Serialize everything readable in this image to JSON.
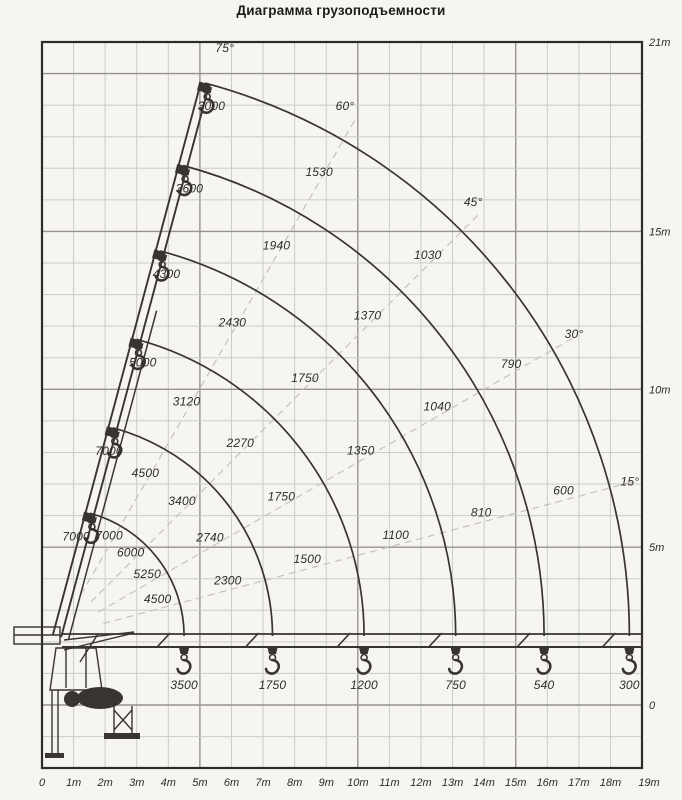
{
  "colors": {
    "background": "#f6f5f2",
    "line": "#38342f",
    "grid_minor": "#cbcbc7",
    "grid_major": "#97948d",
    "frame": "#2d2b27",
    "dashed": "#c6c2bb",
    "text": "#2e2c29"
  },
  "chart_data": {
    "type": "line",
    "title": "Диаграмма грузоподъемности",
    "subtitle": "",
    "units": {
      "load": "kg",
      "distance": "m"
    },
    "x_axis": {
      "range_m": [
        0,
        19
      ],
      "ticks": [
        "0",
        "1m",
        "2m",
        "3m",
        "4m",
        "5m",
        "6m",
        "7m",
        "8m",
        "9m",
        "10m",
        "11m",
        "12m",
        "13m",
        "14m",
        "15m",
        "16m",
        "17m",
        "18m",
        "19m"
      ]
    },
    "y_axis": {
      "side": "right",
      "range_m": [
        -2,
        21
      ],
      "ticks": [
        {
          "label": "21m",
          "m": 21
        },
        {
          "label": "15m",
          "m": 15
        },
        {
          "label": "10m",
          "m": 10
        },
        {
          "label": "5m",
          "m": 5
        },
        {
          "label": "0",
          "m": 0
        }
      ]
    },
    "grid": {
      "minor_step_m": 1,
      "major_step_m": 5
    },
    "angle_lines": [
      {
        "deg": 75,
        "label": "75°"
      },
      {
        "deg": 60,
        "label": "60°"
      },
      {
        "deg": 45,
        "label": "45°"
      },
      {
        "deg": 30,
        "label": "30°"
      },
      {
        "deg": 15,
        "label": "15°"
      }
    ],
    "extensions": [
      {
        "outreach_m": 4.5,
        "loads": {
          "75": 7000,
          "60": 7000,
          "45": 6000,
          "30": 5250,
          "15": 4500,
          "0": 3500
        }
      },
      {
        "outreach_m": 7.3,
        "loads": {
          "75": 7000,
          "60": 4500,
          "45": 3400,
          "30": 2740,
          "15": 2300,
          "0": 1750
        }
      },
      {
        "outreach_m": 10.2,
        "loads": {
          "75": 5000,
          "60": 3120,
          "45": 2270,
          "30": 1750,
          "15": 1500,
          "0": 1200
        }
      },
      {
        "outreach_m": 13.1,
        "loads": {
          "75": 4300,
          "60": 2430,
          "45": 1750,
          "30": 1350,
          "15": 1100,
          "0": 750
        }
      },
      {
        "outreach_m": 15.9,
        "loads": {
          "75": 3600,
          "60": 1940,
          "45": 1370,
          "30": 1040,
          "15": 810,
          "0": 540
        }
      },
      {
        "outreach_m": 18.6,
        "loads": {
          "75": 3000,
          "60": 1530,
          "45": 1030,
          "30": 790,
          "15": 600,
          "0": 300
        }
      }
    ]
  }
}
